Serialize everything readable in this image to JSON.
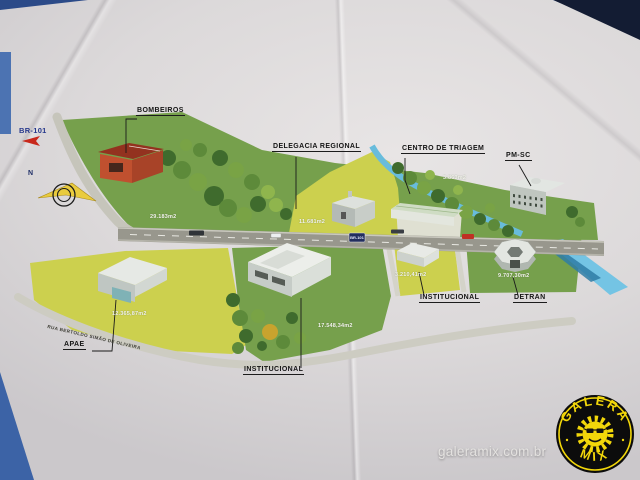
{
  "photo": {
    "watermark": "galeramix.com.br"
  },
  "logo": {
    "top": "GALERA",
    "bottom": "MIX",
    "bg_color": "#0c0c0c",
    "accent_color": "#f2d70a"
  },
  "map": {
    "highway": {
      "ref": "BR-101",
      "shield": "BR-101"
    },
    "compass": {
      "north": "N"
    },
    "street": {
      "name": "RUA BERTOLDO SIMÃO DE OLIVEIRA"
    },
    "sites": {
      "bombeiros": {
        "label": "BOMBEIROS",
        "area": "29.183m2"
      },
      "delegacia": {
        "label": "DELEGACIA REGIONAL",
        "area": "11.681m2"
      },
      "triagem": {
        "label": "CENTRO DE TRIAGEM",
        "area": "3.863m2"
      },
      "pmsc": {
        "label": "PM-SC"
      },
      "apae": {
        "label": "APAE",
        "area": "12.365,87m2"
      },
      "institucional_sul": {
        "label": "INSTITUCIONAL",
        "area": "17.548,34m2"
      },
      "institucional_leste": {
        "label": "INSTITUCIONAL",
        "area": "3.210,41m2"
      },
      "detran": {
        "label": "DETRAN",
        "area": "9.707,30m2"
      }
    },
    "colors": {
      "parcel_green": "#76a04c",
      "parcel_yellow": "#ccd04e",
      "water": "#68bcdc",
      "road": "#98978d"
    }
  }
}
